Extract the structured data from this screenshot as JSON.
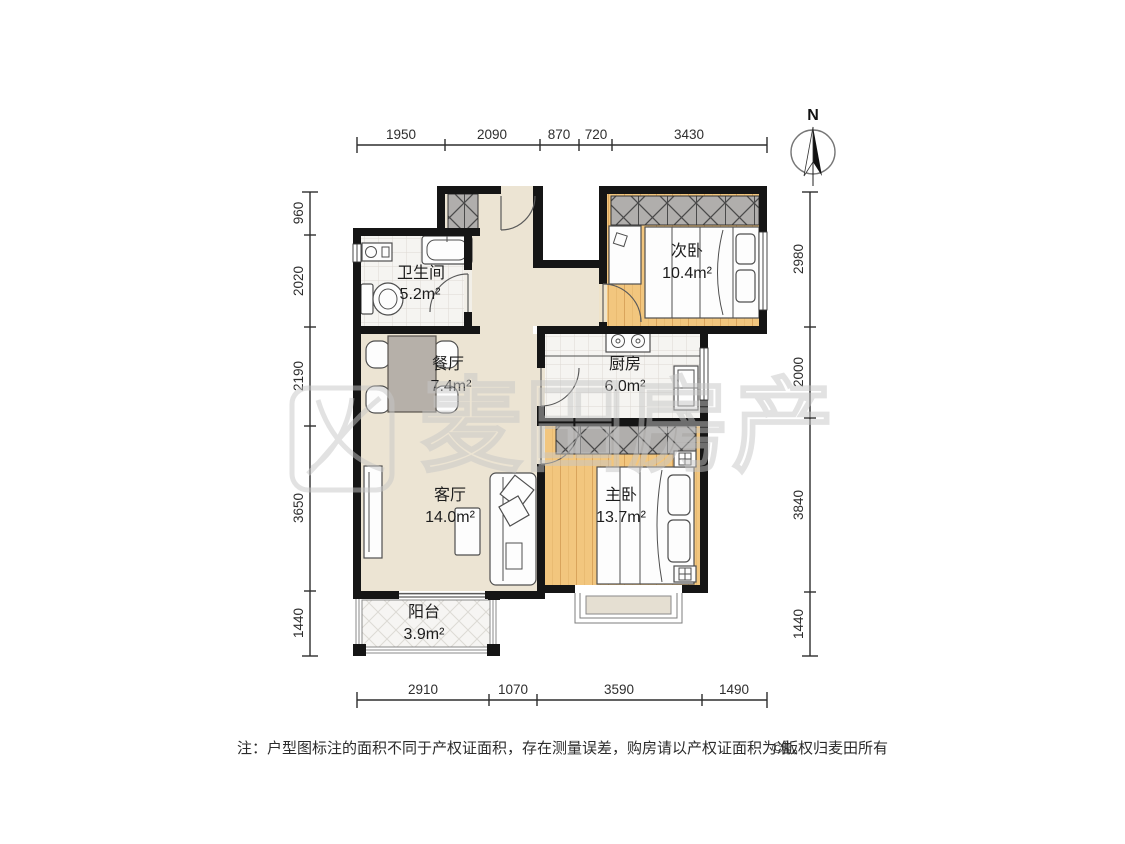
{
  "compass": {
    "label": "N"
  },
  "watermark": {
    "text": "麦田房产"
  },
  "rooms": {
    "bathroom": {
      "name": "卫生间",
      "area": "5.2m²"
    },
    "dining": {
      "name": "餐厅",
      "area": "7.4m²"
    },
    "living": {
      "name": "客厅",
      "area": "14.0m²"
    },
    "balcony": {
      "name": "阳台",
      "area": "3.9m²"
    },
    "bedroom2": {
      "name": "次卧",
      "area": "10.4m²"
    },
    "kitchen": {
      "name": "厨房",
      "area": "6.0m²"
    },
    "master": {
      "name": "主卧",
      "area": "13.7m²"
    }
  },
  "dimensions": {
    "top": [
      "1950",
      "2090",
      "870",
      "720",
      "3430"
    ],
    "bottom": [
      "2910",
      "1070",
      "3590",
      "1490"
    ],
    "left": [
      "960",
      "2020",
      "2190",
      "3650",
      "1440"
    ],
    "right": [
      "2980",
      "2000",
      "3840",
      "1440"
    ]
  },
  "footer": {
    "note": "注：户型图标注的面积不同于产权证面积，存在测量误差，购房请以产权证面积为准。",
    "copyright": "©版权归麦田所有"
  },
  "colors": {
    "wall": "#151515",
    "wood_floor": "#f2c67e",
    "public_floor": "#ece4d3",
    "tile_floor": "#f5f4f1",
    "wardrobe": "#b0aeac",
    "dining_table": "#b6b0a9",
    "watermark_gray": "#c7c7c7"
  }
}
